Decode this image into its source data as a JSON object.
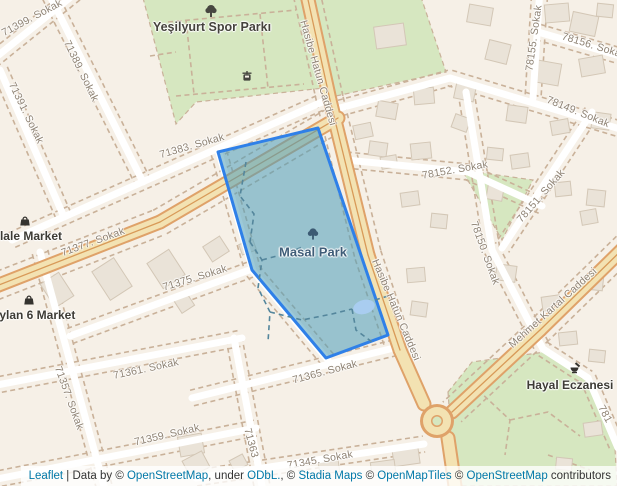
{
  "pois": {
    "yesilyurt": "Yeşilyurt Spor Parkı",
    "masal": "Masal Park",
    "market1": "zlale Market",
    "market2": "eylan 6 Market",
    "pharmacy": "Hayal Eczanesi"
  },
  "streets": {
    "s71399": "71399. Sokak",
    "s71389": "71389. Sokak",
    "s71391": "71391. Sokak",
    "s71383": "71383. Sokak",
    "s71377": "71377. Sokak",
    "s71375": "71375. Sokak",
    "s71361": "71361. Sokak",
    "s71357": "71357. Sokak",
    "s71359": "71359. Sokak",
    "s71363": "71363",
    "s71365": "71365. Sokak",
    "s71345": "71345. Sokak",
    "hasibe1": "Hasibe Hatun Caddesi",
    "hasibe2": "Hasibe Hatun Caddesi",
    "s78152": "78152. Sokak",
    "s78155": "78155. Sokak",
    "s78156": "78156. Sokak",
    "s78149": "78149. Sokak",
    "s78151": "78151. Sokak",
    "s78150": "78150. Sokak",
    "mehmet": "Mehmet Kartal Caddesi",
    "s781": "781"
  },
  "attribution": {
    "leaflet": "Leaflet",
    "t1": " | Data by © ",
    "osm1": "OpenStreetMap",
    "t2": ", under ",
    "odbl": "ODbL.",
    "t3": ", © ",
    "stadia": "Stadia Maps",
    "t4": " © ",
    "omt": "OpenMapTiles",
    "t5": " © ",
    "osm2": "OpenStreetMap",
    "t6": " contributors"
  },
  "colors": {
    "background": "#f6f0e7",
    "park_green": "#d6e7c0",
    "building": "#eae3d8",
    "road_main_fill": "#f3e2b2",
    "road_main_casing": "#dfa269",
    "road_minor": "#ffffff",
    "lot_dashes": "#c9b199",
    "highlight_fill": "#4b9cb9",
    "highlight_stroke": "#2f80e8",
    "pond": "#a9cdf0",
    "street_label": "#8e8273",
    "link": "#0078A8"
  }
}
